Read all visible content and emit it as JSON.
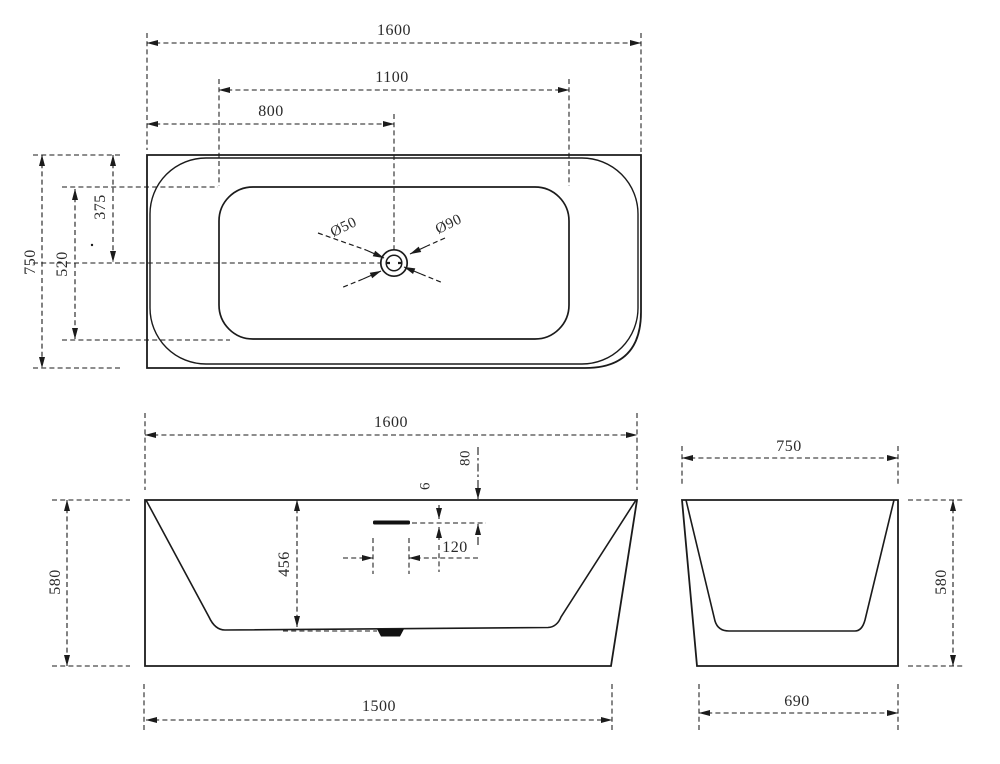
{
  "drawing": {
    "type": "bathtub technical drawing, three orthographic views",
    "colors": {
      "line": "#1b1b1b",
      "text": "#2a2a2a",
      "background": "#ffffff"
    },
    "top_view": {
      "length_overall": "1600",
      "length_inner": "1100",
      "drain_offset_from_left": "800",
      "width_overall": "750",
      "width_inner": "520",
      "drain_offset_from_top": "375",
      "drain_inner_diameter": "Ø50",
      "drain_outer_diameter": "Ø90"
    },
    "front_view": {
      "length_overall": "1600",
      "overflow_offset_from_rim": "80",
      "overflow_slot_height": "6",
      "overflow_slot_width": "120",
      "depth_inner": "456",
      "height_overall": "580",
      "length_base": "1500"
    },
    "side_view": {
      "width_overall": "750",
      "height_overall": "580",
      "width_base": "690"
    }
  }
}
